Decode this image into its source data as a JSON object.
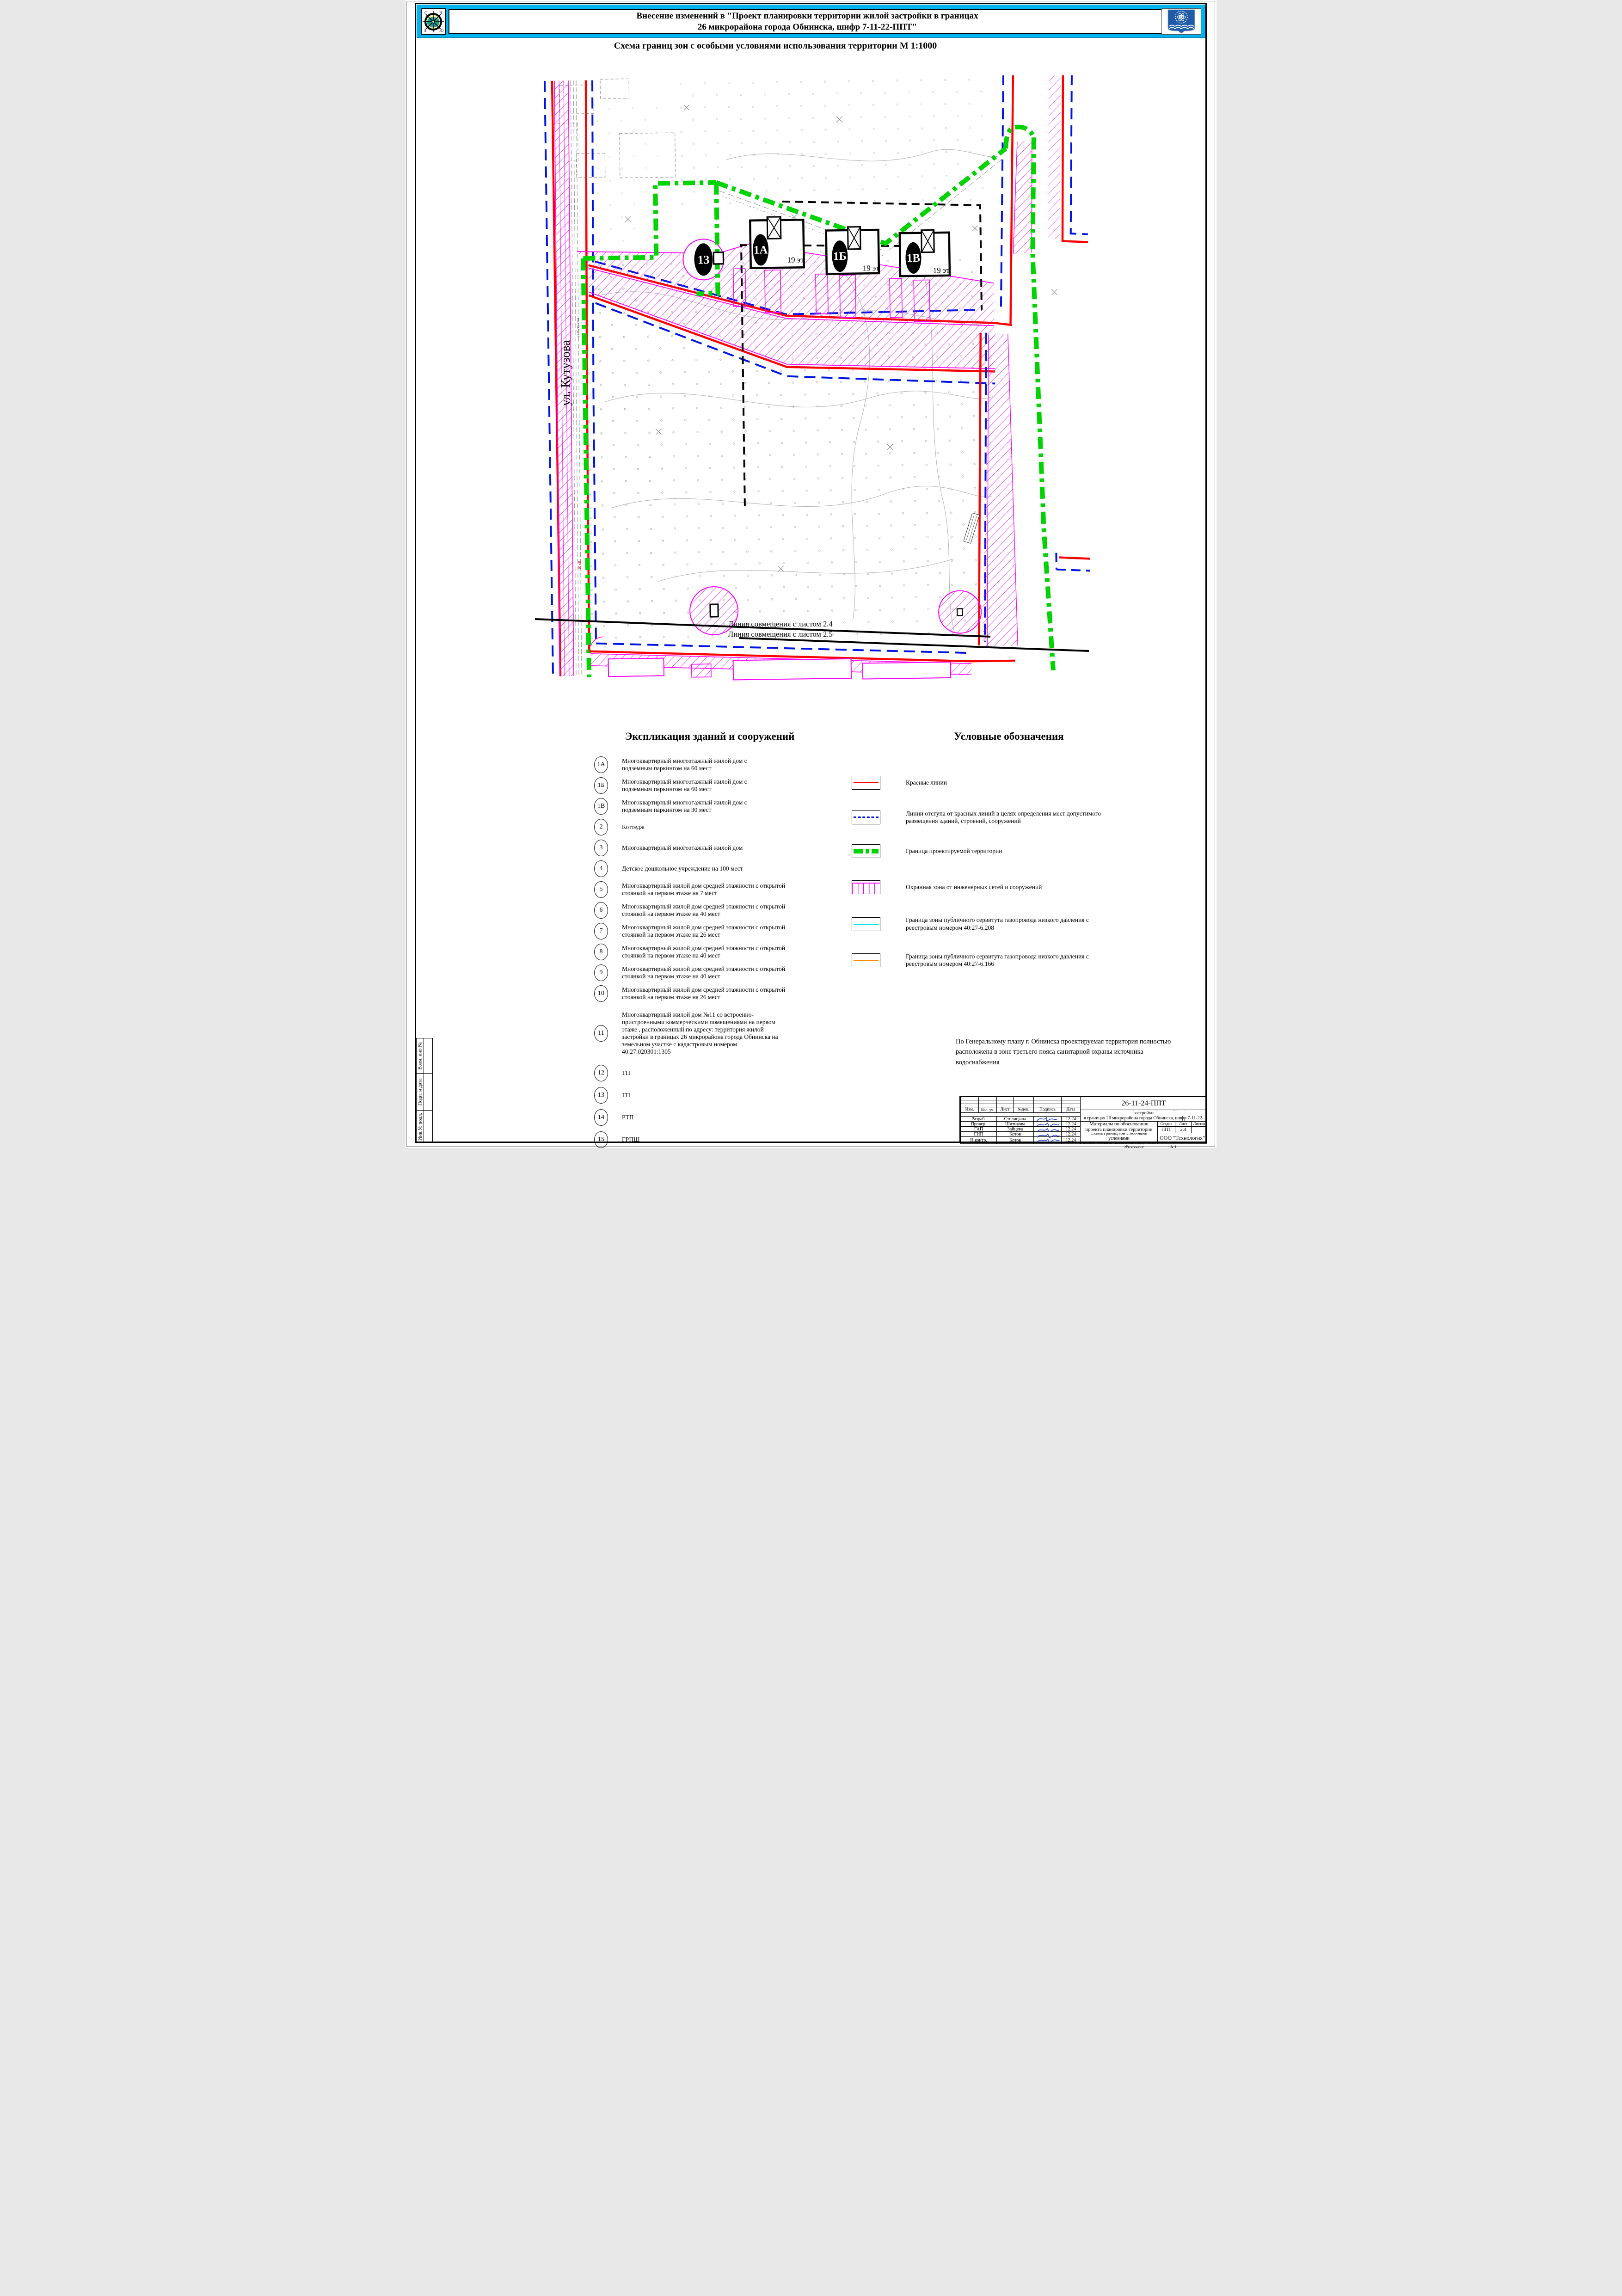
{
  "header": {
    "title_line1": "Внесение изменений в \"Проект планировки территории жилой застройки в границах",
    "title_line2": "26 микрорайона города Обнинска, шифр 7-11-22-ППТ\"",
    "compass": {
      "n": "С",
      "e": "В",
      "w": "З",
      "s": "Ю"
    }
  },
  "subtitle": "Схема границ зон с особыми условиями использования территории  М 1:1000",
  "map": {
    "street_label": "ул. Кутузова",
    "street_label_small": "ул.Кутузова",
    "power_label": "10 кВ",
    "match_line_1": "Линия совмещения с листом 2.4",
    "match_line_2": "Линия совмещения с листом 2.5",
    "object_13": "13",
    "buildings": [
      {
        "id": "1А",
        "floors": "19 эт."
      },
      {
        "id": "1Б",
        "floors": "19 эт."
      },
      {
        "id": "1В",
        "floors": "19 эт."
      }
    ]
  },
  "explication": {
    "title": "Экспликация зданий и сооружений",
    "items": [
      {
        "num": "1А",
        "text": "Многоквартирный многоэтажный жилой дом с подземным паркингом на 60 мест"
      },
      {
        "num": "1Б",
        "text": "Многоквартирный многоэтажный жилой дом с подземным паркингом на 60 мест"
      },
      {
        "num": "1В",
        "text": "Многоквартирный многоэтажный жилой дом с подземным паркингом на 30 мест"
      },
      {
        "num": "2",
        "text": "Коттедж"
      },
      {
        "num": "3",
        "text": "Многоквартирный многоэтажный жилой дом"
      },
      {
        "num": "4",
        "text": "Детское дошкольное учреждение на 100 мест"
      },
      {
        "num": "5",
        "text": "Многоквартирный  жилой дом средней этажности с открытой стоянкой на первом этаже на 7 мест"
      },
      {
        "num": "6",
        "text": "Многоквартирный  жилой дом средней этажности с открытой стоянкой на первом этаже на 40 мест"
      },
      {
        "num": "7",
        "text": "Многоквартирный  жилой дом средней этажности с открытой стоянкой на первом этаже на 26 мест"
      },
      {
        "num": "8",
        "text": "Многоквартирный  жилой дом средней этажности с открытой стоянкой на первом этаже на 40 мест"
      },
      {
        "num": "9",
        "text": "Многоквартирный  жилой дом средней этажности с открытой стоянкой на первом этаже на 40 мест"
      },
      {
        "num": "10",
        "text": "Многоквартирный  жилой дом средней этажности с открытой стоянкой на первом этаже на 26 мест"
      },
      {
        "num": "11",
        "text": "Многоквартирный жилой дом №11 со встроенно-пристроенными коммерческими помещениями на первом этаже , расположенный по адресу: территория жилой застройки в границах 26 микрорайона города Обнинска на земельном участке с кадастровым номером 40:27:020301:1305"
      },
      {
        "num": "12",
        "text": "ТП"
      },
      {
        "num": "13",
        "text": "ТП"
      },
      {
        "num": "14",
        "text": "РТП"
      },
      {
        "num": "15",
        "text": "ГРПШ"
      },
      {
        "num": "16",
        "text": "ТП"
      }
    ]
  },
  "legend": {
    "title": "Условные обозначения",
    "items": [
      {
        "symbol": "red-line",
        "label": "Красные линии"
      },
      {
        "symbol": "blue-dashed-line",
        "label": "Линии отступа от красных линий в целях определения мест допустимого размещения зданий, строений, сооружений"
      },
      {
        "symbol": "green-boundary",
        "label": "Граница проектируемой территории"
      },
      {
        "symbol": "magenta-hatch",
        "label": "Охранная зона от инженерных сетей и сооружений"
      },
      {
        "symbol": "cyan-line",
        "label": "Граница зоны публичного сервитута газопровода низкого давления с реестровым номером 40:27-6.208"
      },
      {
        "symbol": "orange-line",
        "label": "Граница зоны публичного сервитута газопровода низкого давления с реестровым номером 40:27-6.166"
      }
    ]
  },
  "note_line1": "По Генеральному плану г. Обнинска проектируемая территория полностью",
  "note_line2": "расположена в зоне третьего пояса санитарной охраны источника водоснабжения",
  "titleblock": {
    "doc_code": "26-11-24-ППТ",
    "project_line1": "Внесение изменений в \"Проект планировки территории жилой застройки",
    "project_line2": "в границах 26 микрорайона города Обнинска, шифр 7-11-22-ППТ\"",
    "columns": [
      "Изм.",
      "Кол. уч.",
      "Лист",
      "№док.",
      "Подпись",
      "Дата"
    ],
    "staff": [
      {
        "role": "Разраб.",
        "name": "Столицына",
        "date": "12.24"
      },
      {
        "role": "Провер.",
        "name": "Шитикова",
        "date": "12.24"
      },
      {
        "role": "ГАП",
        "name": "Зайцева",
        "date": "12.24"
      },
      {
        "role": "ГИП",
        "name": "Котов",
        "date": "12.24"
      },
      {
        "role": "Н.контр.",
        "name": "Котов",
        "date": "12.24"
      }
    ],
    "materials": "Материалы по обоснованию проекта планировки территории",
    "sheet_title_line1": "Схема границ зон с особыми условиями",
    "sheet_title_line2": "использования территории М 1:1000",
    "stage_label": "Стадия",
    "sheet_label": "Лист",
    "sheets_label": "Листов",
    "stage_value": "ППТ",
    "sheet_value": "2.4",
    "sheets_value": "",
    "company": "ООО \"Технология\""
  },
  "sidebar": {
    "cells": [
      "Взам. инв.№",
      "Подп. и дата",
      "Инв.№ подл."
    ]
  },
  "page": {
    "format_label": "Формат",
    "format_value": "А1"
  },
  "colors": {
    "banner_cyan": "#00b5ef",
    "red_line": "#ff0000",
    "setback_blue": "#0016e0",
    "boundary_green": "#00d300",
    "zone_magenta": "#ff00ff",
    "servitude_cyan": "#00e6e6",
    "servitude_orange": "#ff8c00",
    "coat_blue": "#1f5ca8",
    "signature_blue": "#1a3fd4"
  }
}
